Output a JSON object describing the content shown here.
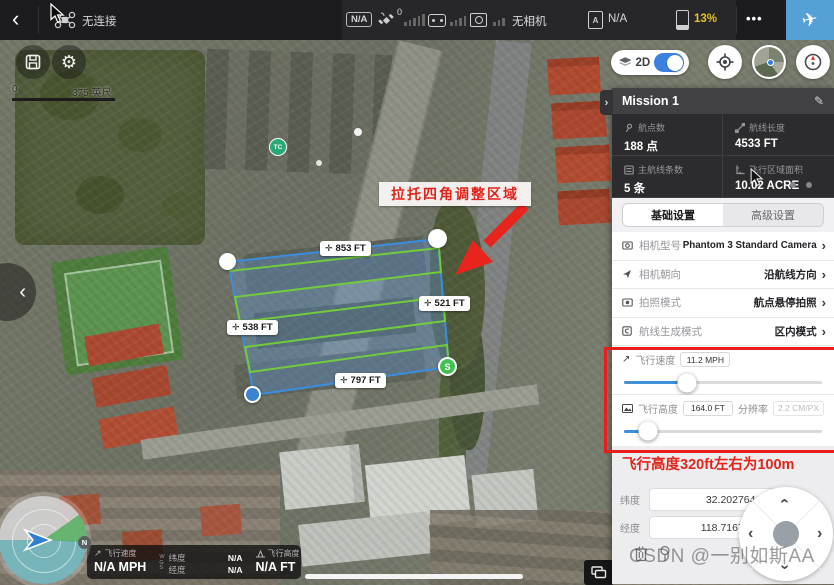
{
  "topbar": {
    "connection": "无连接",
    "gps_badge": "N/A",
    "gps_count": "0",
    "camera_status": "无相机",
    "checklist_value": "N/A",
    "battery_percent": "13%"
  },
  "map": {
    "scale_start": "0",
    "scale_end": "375 英尺",
    "mode_2d": "2D",
    "poi_label": "TC",
    "annotation": "拉托四角调整区域",
    "distances": [
      {
        "label": "853 FT"
      },
      {
        "label": "521 FT"
      },
      {
        "label": "538 FT"
      },
      {
        "label": "797 FT"
      }
    ],
    "start_marker": "S",
    "compass_north": "N"
  },
  "telemetry": {
    "speed_label": "飞行速度",
    "speed_value": "N/A MPH",
    "wgs_w": "W",
    "wgs_g": "G",
    "wgs_s": "S",
    "lat_label": "纬度",
    "lat_value": "N/A",
    "lng_label": "经度",
    "lng_value": "N/A",
    "alt_label": "飞行高度",
    "alt_value": "N/A FT"
  },
  "panel": {
    "title": "Mission 1",
    "stats": [
      {
        "label": "航点数",
        "value": "188 点"
      },
      {
        "label": "航线长度",
        "value": "4533 FT"
      },
      {
        "label": "主航线条数",
        "value": "5 条"
      },
      {
        "label": "飞行区域面积",
        "value": "10.02 ACRE"
      }
    ],
    "tabs": [
      {
        "label": "基础设置"
      },
      {
        "label": "高级设置"
      }
    ],
    "settings": [
      {
        "label": "相机型号",
        "value": "Phantom 3 Standard Camera"
      },
      {
        "label": "相机朝向",
        "value": "沿航线方向"
      },
      {
        "label": "拍照模式",
        "value": "航点悬停拍照"
      },
      {
        "label": "航线生成模式",
        "value": "区内模式"
      }
    ],
    "speed": {
      "label": "飞行速度",
      "value": "11.2 MPH",
      "percent": 32
    },
    "altitude": {
      "label": "飞行高度",
      "value": "164.0 FT",
      "res_label": "分辨率",
      "res_value": "2.2 CM/PX",
      "percent": 12
    },
    "note": "飞行高度320ft左右为100m",
    "coords": {
      "lat_label": "纬度",
      "lat_value": "32.202764195",
      "lng_label": "经度",
      "lng_value": "118.716763493"
    }
  },
  "watermark": "CSDN @一别如斯AA",
  "icons": {
    "back": "‹",
    "collapse_left": "‹",
    "collapse_right": "›",
    "chevron": "›",
    "edit": "✎",
    "gear": "⚙",
    "more": "•••",
    "plane": "✈",
    "move": "✛",
    "speed": "↗",
    "dpad_up": "›",
    "dpad_down": "›",
    "dpad_left": "‹",
    "dpad_right": "›"
  },
  "colors": {
    "accent_blue": "#55a1d6",
    "slider_blue": "#3f8fd9",
    "alert_red": "#e81e1e",
    "battery_yellow": "#e6c11f",
    "polygon_blue": "#3b8de0",
    "route_green": "#72cb3d",
    "start_green": "#3fc24f"
  }
}
